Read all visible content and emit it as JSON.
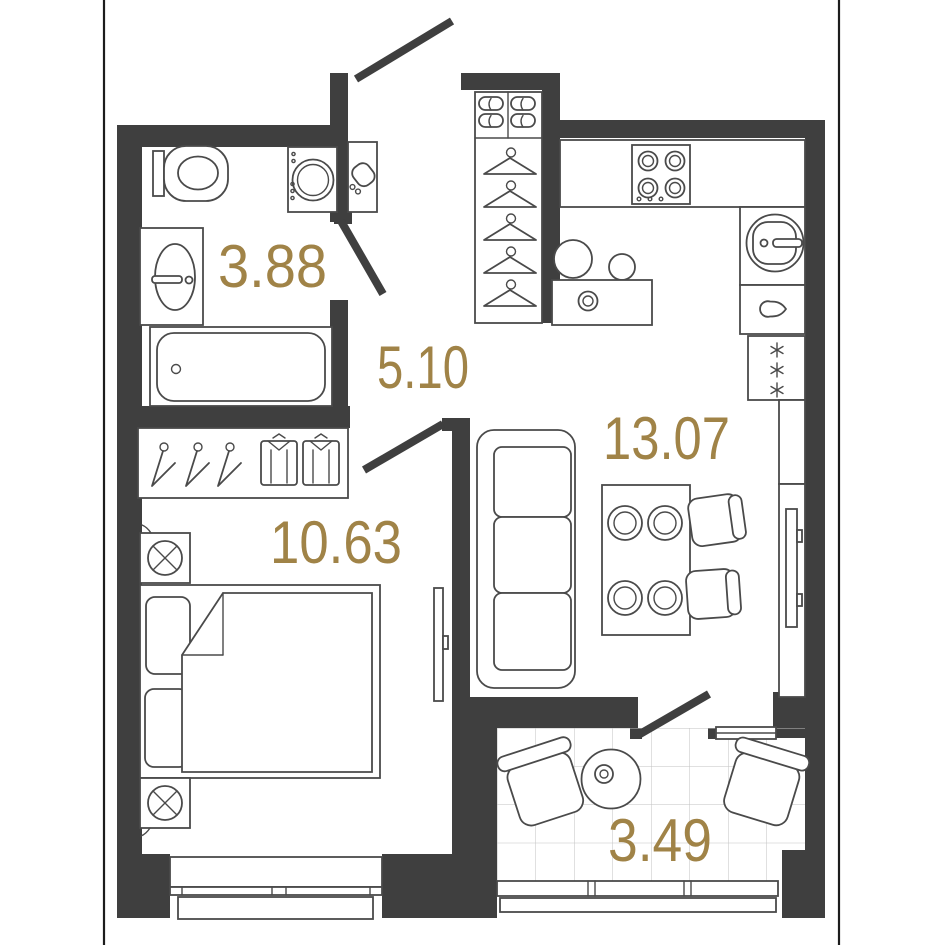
{
  "floorplan": {
    "rooms": {
      "bathroom": {
        "area": "3.88"
      },
      "hallway": {
        "area": "5.10"
      },
      "kitchen_living": {
        "area": "13.07"
      },
      "bedroom": {
        "area": "10.63"
      },
      "balcony": {
        "area": "3.49"
      }
    },
    "colors": {
      "wall": "#3F3F3F",
      "furniture_line": "#4A4A4A",
      "area_label": "#A08347",
      "tile_line": "#C2C2C2",
      "background": "#FFFFFF"
    }
  }
}
